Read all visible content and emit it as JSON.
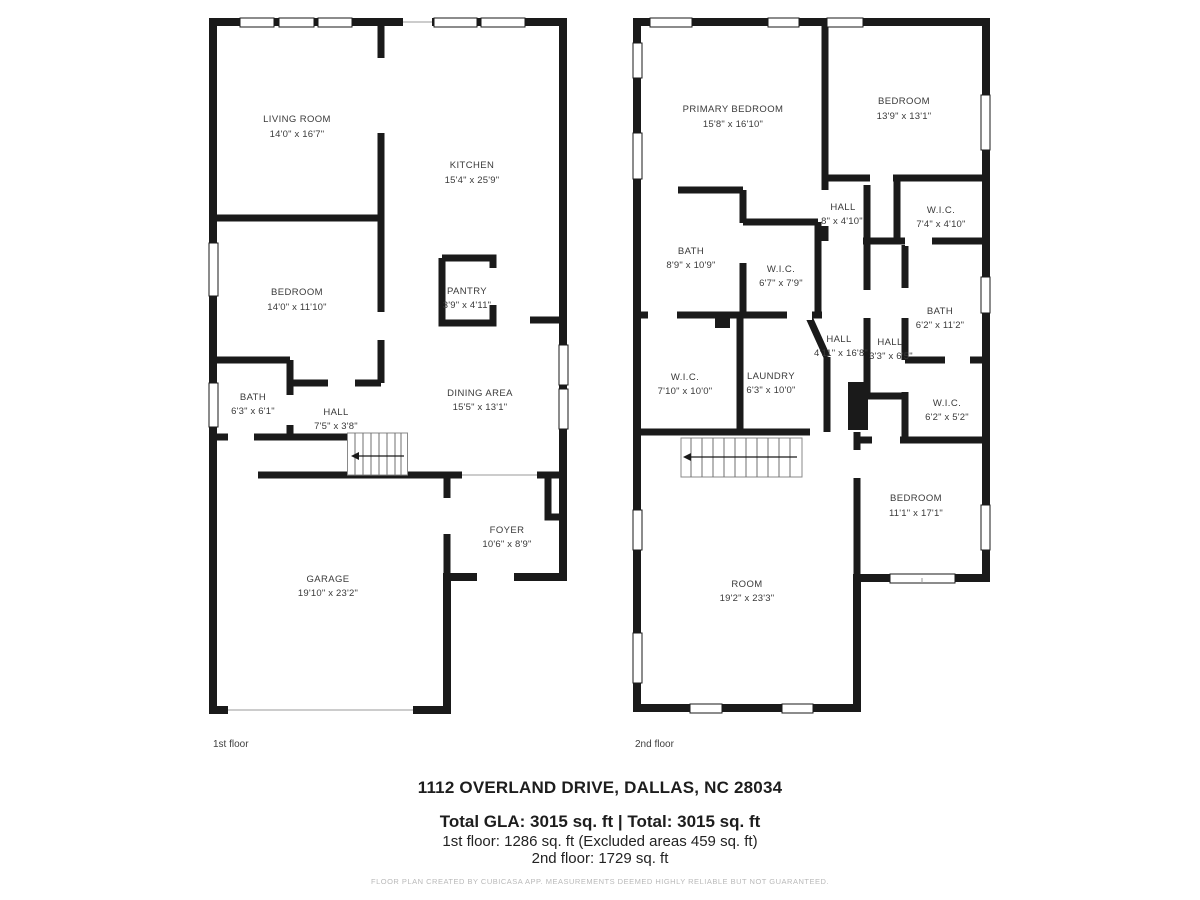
{
  "floor1": {
    "caption": "1st floor",
    "rooms": {
      "living": {
        "name": "LIVING ROOM",
        "dims": "14'0\" x 16'7\""
      },
      "kitchen": {
        "name": "KITCHEN",
        "dims": "15'4\" x 25'9\""
      },
      "bedroom": {
        "name": "BEDROOM",
        "dims": "14'0\" x 11'10\""
      },
      "pantry": {
        "name": "PANTRY",
        "dims": "3'9\" x 4'11\""
      },
      "bath": {
        "name": "BATH",
        "dims": "6'3\" x 6'1\""
      },
      "hall": {
        "name": "HALL",
        "dims": "7'5\" x 3'8\""
      },
      "dining": {
        "name": "DINING AREA",
        "dims": "15'5\" x 13'1\""
      },
      "foyer": {
        "name": "FOYER",
        "dims": "10'6\" x 8'9\""
      },
      "garage": {
        "name": "GARAGE",
        "dims": "19'10\" x 23'2\""
      }
    }
  },
  "floor2": {
    "caption": "2nd floor",
    "rooms": {
      "primary": {
        "name": "PRIMARY BEDROOM",
        "dims": "15'8\" x 16'10\""
      },
      "bedroom_tr": {
        "name": "BEDROOM",
        "dims": "13'9\" x 13'1\""
      },
      "hall_top": {
        "name": "HALL",
        "dims": "8\" x 4'10\""
      },
      "wic_top": {
        "name": "W.I.C.",
        "dims": "7'4\" x 4'10\""
      },
      "bath_top": {
        "name": "BATH",
        "dims": "8'9\" x 10'9\""
      },
      "wic_mid": {
        "name": "W.I.C.",
        "dims": "6'7\" x 7'9\""
      },
      "bath_right": {
        "name": "BATH",
        "dims": "6'2\" x 11'2\""
      },
      "hall_main": {
        "name": "HALL",
        "dims": "4'11\" x 16'8\""
      },
      "hall_right": {
        "name": "HALL",
        "dims": "3'3\" x 6'5\""
      },
      "wic_left": {
        "name": "W.I.C.",
        "dims": "7'10\" x 10'0\""
      },
      "laundry": {
        "name": "LAUNDRY",
        "dims": "6'3\" x 10'0\""
      },
      "wic_right": {
        "name": "W.I.C.",
        "dims": "6'2\" x 5'2\""
      },
      "bedroom_br": {
        "name": "BEDROOM",
        "dims": "11'1\" x 17'1\""
      },
      "room": {
        "name": "ROOM",
        "dims": "19'2\" x 23'3\""
      }
    }
  },
  "footer": {
    "address": "1112 OVERLAND DRIVE, DALLAS, NC 28034",
    "total": "Total GLA: 3015 sq. ft | Total: 3015 sq. ft",
    "floor1_area": "1st floor: 1286 sq. ft (Excluded areas 459 sq. ft)",
    "floor2_area": "2nd floor: 1729 sq. ft",
    "disclaimer": "FLOOR PLAN CREATED BY CUBICASA APP. MEASUREMENTS DEEMED HIGHLY RELIABLE BUT NOT GUARANTEED."
  },
  "colors": {
    "wall": "#1a1a1a",
    "text": "#3a3a3a",
    "muted": "#b9b9b9"
  }
}
